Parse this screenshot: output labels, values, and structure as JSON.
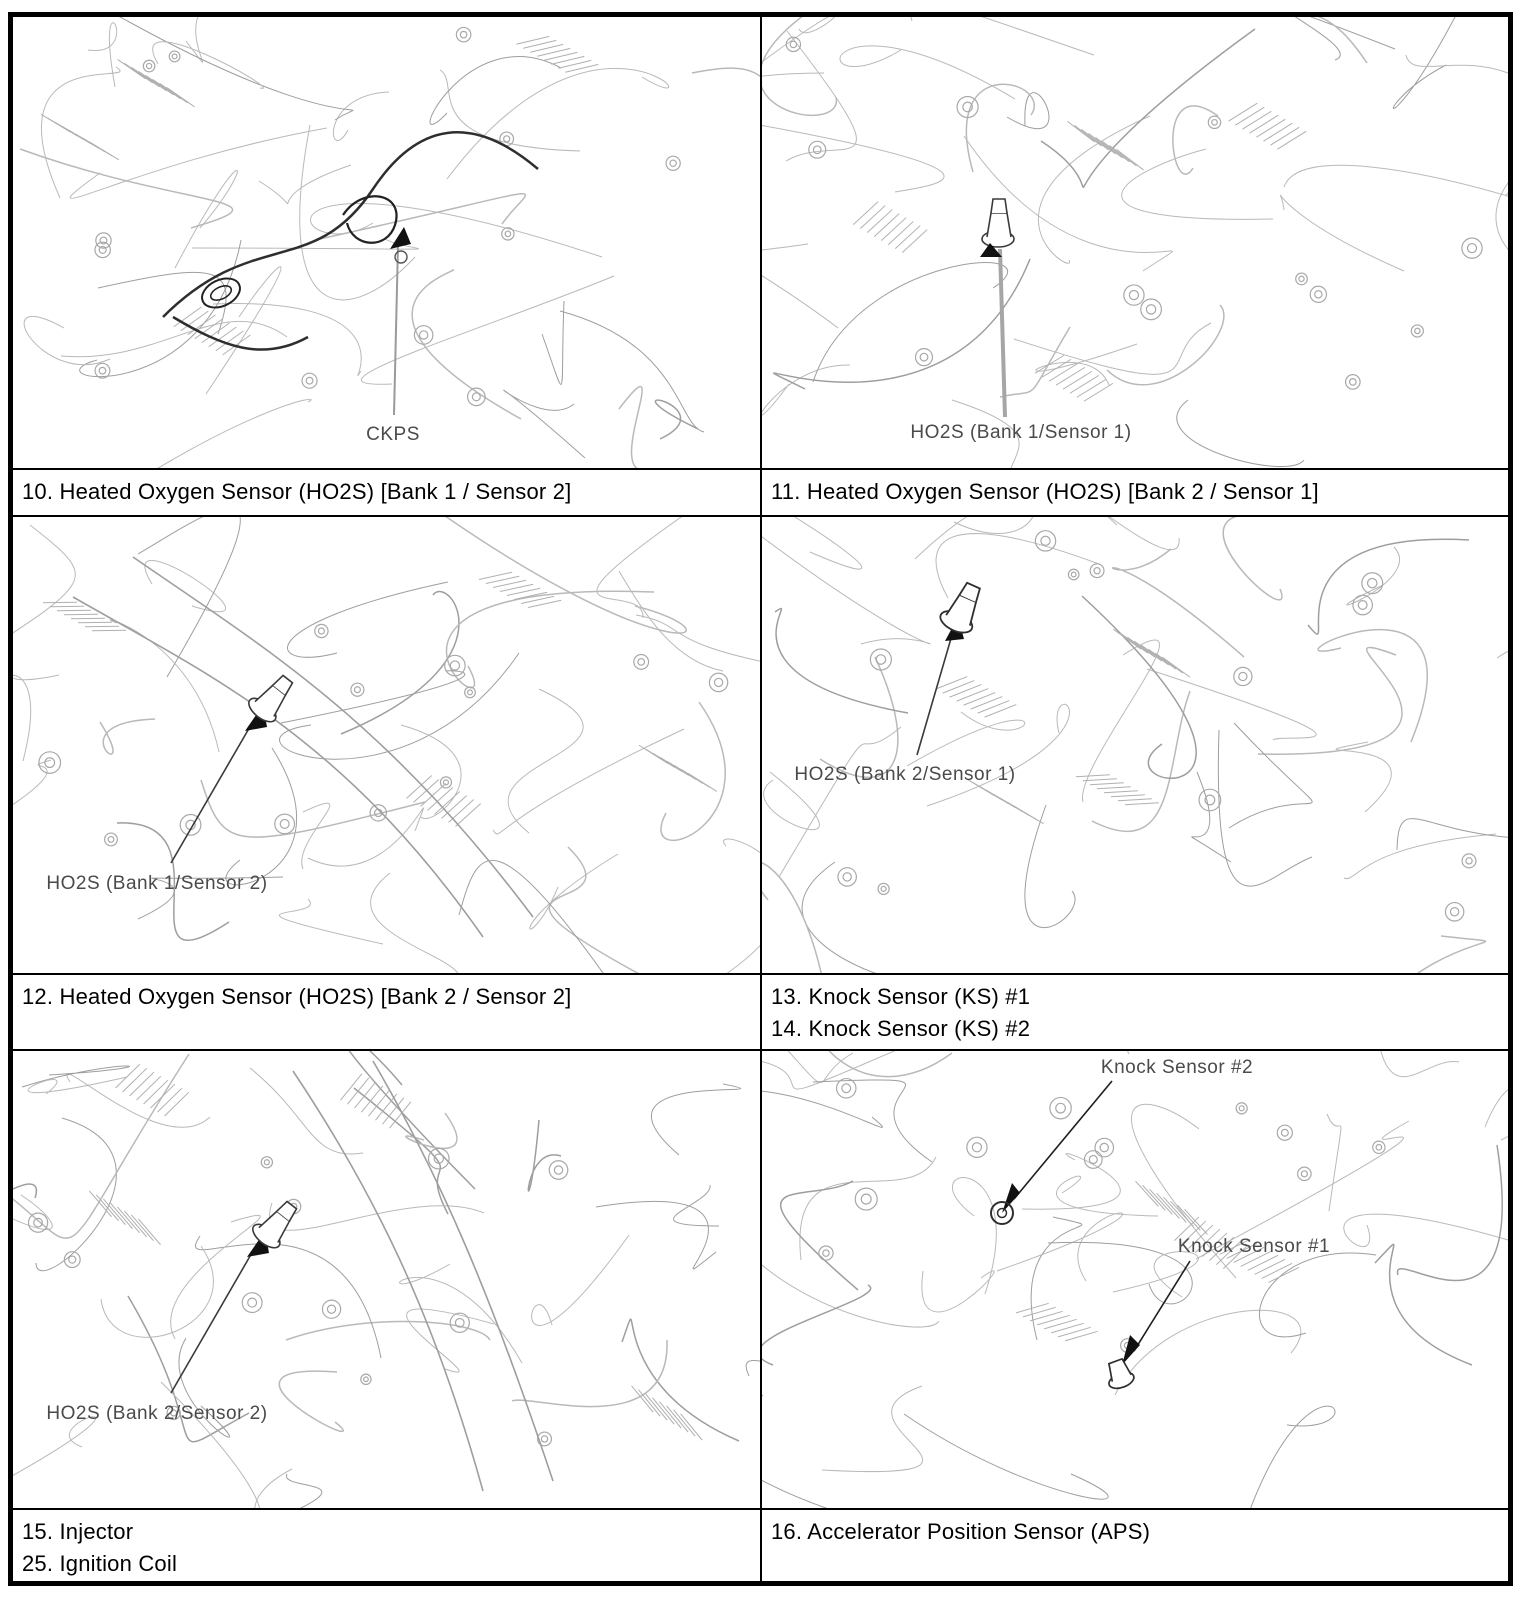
{
  "panels": {
    "p10": {
      "label": "CKPS"
    },
    "p11": {
      "label": "HO2S (Bank 1/Sensor 1)"
    },
    "p12": {
      "label": "HO2S (Bank 1/Sensor 2)"
    },
    "p13": {
      "label": "HO2S (Bank 2/Sensor 1)"
    },
    "p15": {
      "label": "HO2S (Bank 2/Sensor 2)"
    },
    "p16": {
      "label_ks2": "Knock Sensor #2",
      "label_ks1": "Knock Sensor #1"
    }
  },
  "captions": {
    "c10": "10. Heated Oxygen Sensor (HO2S) [Bank 1 / Sensor 2]",
    "c11": "11. Heated Oxygen Sensor (HO2S) [Bank 2 / Sensor 1]",
    "c12": "12. Heated Oxygen Sensor (HO2S) [Bank 2 / Sensor 2]",
    "c13": "13. Knock Sensor (KS) #1",
    "c14": "14. Knock Sensor (KS) #2",
    "c15": "15. Injector",
    "c25": "25. Ignition Coil",
    "c16": "16. Accelerator Position Sensor (APS)"
  },
  "colors": {
    "line_art": "#b9b9b9",
    "label_text": "#4a4a4a",
    "caption_text": "#000000",
    "grid_border": "#000000"
  }
}
